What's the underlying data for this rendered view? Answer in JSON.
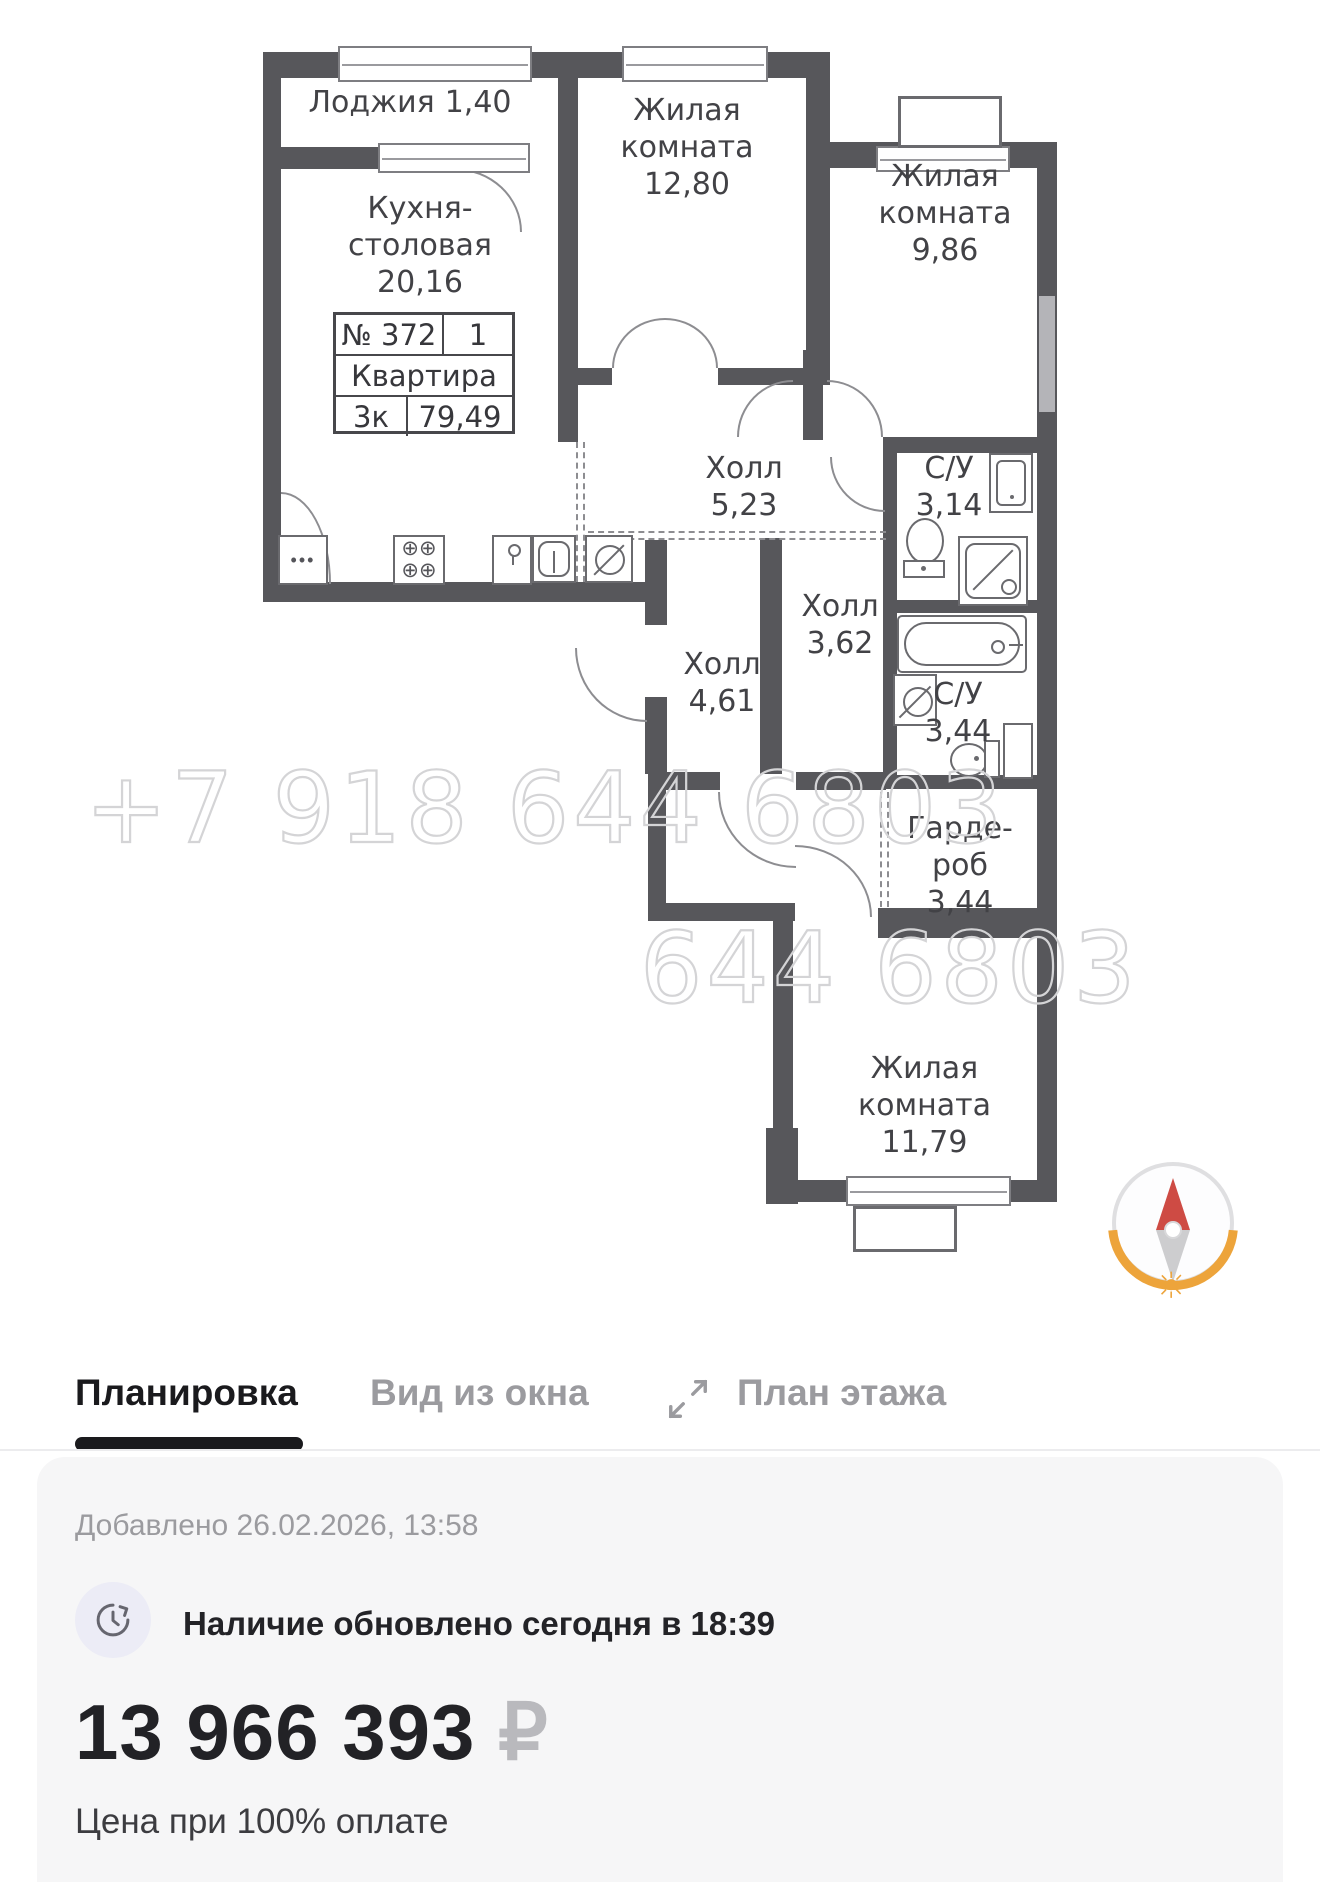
{
  "floorplan": {
    "watermark": "+7 918 644 6803",
    "watermark_clip": "644 6803",
    "unit_card": {
      "number": "№ 372",
      "entrance": "1",
      "type": "Квартира",
      "rooms": "3к",
      "total_area": "79,49"
    },
    "rooms": {
      "loggia": {
        "name": "Лоджия",
        "area": "1,40"
      },
      "kitchen": {
        "name": "Кухня-столовая",
        "area": "20,16"
      },
      "living1": {
        "name": "Жилая комната",
        "area": "12,80"
      },
      "living2": {
        "name": "Жилая комната",
        "area": "9,86"
      },
      "hall1": {
        "name": "Холл",
        "area": "5,23"
      },
      "bath1": {
        "name": "С/У",
        "area": "3,14"
      },
      "hall2": {
        "name": "Холл",
        "area": "3,62"
      },
      "hall3": {
        "name": "Холл",
        "area": "4,61"
      },
      "bath2": {
        "name": "С/У",
        "area": "3,44"
      },
      "wardrobe": {
        "name": "Гарде-роб",
        "area": "3,44"
      },
      "living3": {
        "name": "Жилая комната",
        "area": "11,79"
      }
    }
  },
  "tabs": [
    {
      "label": "Планировка",
      "active": true
    },
    {
      "label": "Вид из окна",
      "active": false
    },
    {
      "label": "План этажа",
      "active": false
    }
  ],
  "details": {
    "added": "Добавлено 26.02.2026, 13:58",
    "availability": "Наличие обновлено сегодня в 18:39",
    "price": "13 966 393",
    "currency": "₽",
    "payment_note": "Цена при 100% оплате"
  },
  "colors": {
    "wall": "#57575b",
    "accent_active": "#1a1a1d",
    "tab_inactive": "#9b9b9f",
    "compass_orange": "#eda43b",
    "compass_red": "#ce4b44",
    "card_bg": "#f6f6f7"
  }
}
